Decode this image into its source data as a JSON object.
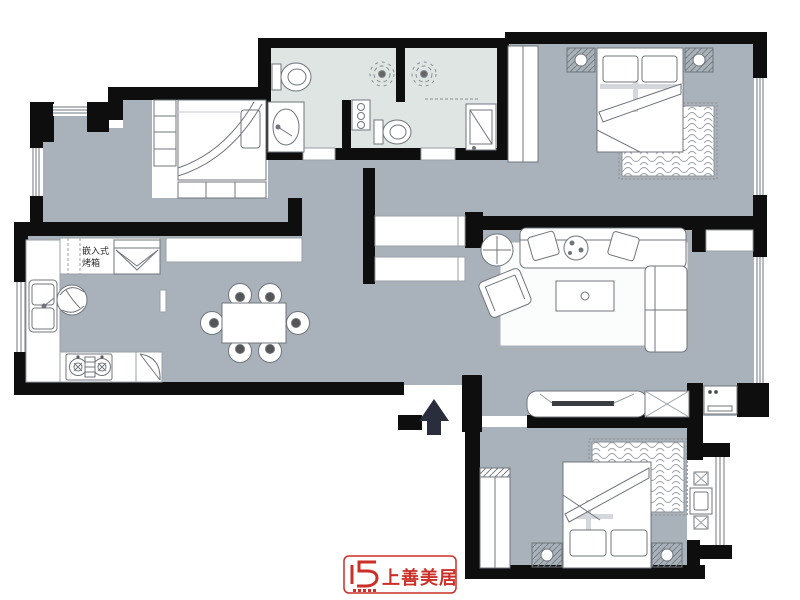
{
  "page": {
    "type": "apartment-floor-plan",
    "canvas": {
      "width": 800,
      "height": 600
    }
  },
  "labels": {
    "oven_line1": "嵌入式",
    "oven_line2": "烤箱"
  },
  "logo": {
    "text": "上善美居",
    "color": "#cb2f27"
  },
  "colors": {
    "floor_gray": "#a9b2ba",
    "bathroom_floor": "#dfe5e2",
    "wall_black": "#0e0e0e",
    "furniture_stroke": "#70757c",
    "rug_line": "#9aa0a6",
    "north_arrow": "#2a2d3b",
    "logo_red": "#cb2f27"
  },
  "icons": [
    "north-arrow-icon",
    "single-bed",
    "double-bed",
    "wardrobe",
    "nightstand",
    "rug",
    "sofa",
    "armchair",
    "coffee-table",
    "tv-stand",
    "dining-table",
    "dining-chair",
    "kitchen-sink",
    "gas-stove",
    "built-in-oven",
    "plant",
    "toilet",
    "vanity-sink",
    "shower-head",
    "washing-machine",
    "balcony-table",
    "balcony-chair",
    "hall-cabinet",
    "window",
    "door-opening"
  ]
}
